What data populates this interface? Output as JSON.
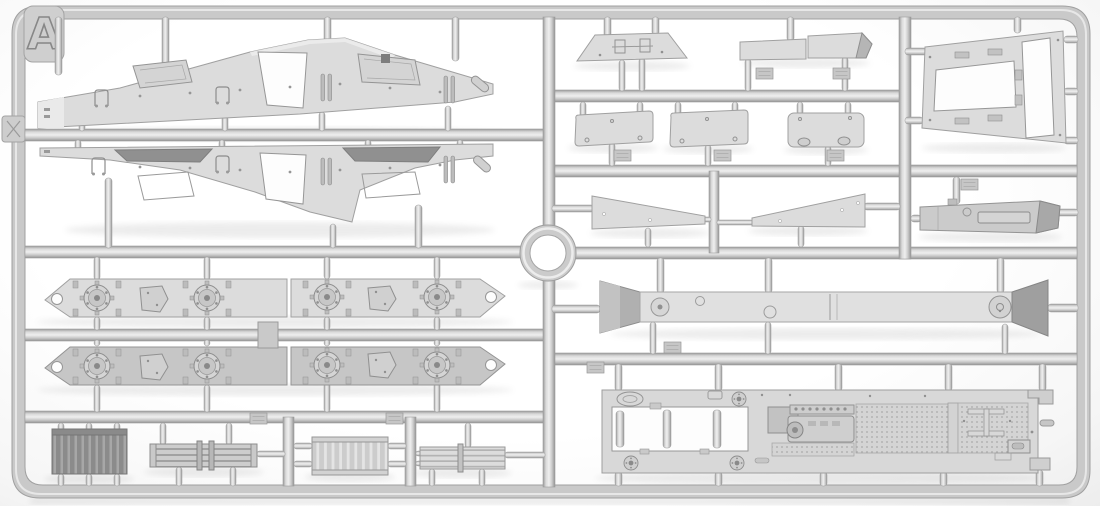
{
  "sprue": {
    "label": "A",
    "subject": "injection-molded plastic model kit sprue (parts frame) photographed on a white background",
    "plastic_color_hex": "#d3d3d3",
    "frame_color_hex": "#c9c9c9",
    "background_hex": "#ffffff",
    "sections": {
      "top_left": [
        {
          "name": "upper-hull-side-panel-a",
          "description": "long tapered hull/fender panel, center peak pointing up, trapezoidal cutout, two hatch outlines, hinge bars, bolt rows"
        },
        {
          "name": "upper-hull-side-panel-b",
          "description": "mirrored long tapered hull/fender panel, center peak pointing down, two dark recessed intakes, trapezoidal cutout, hatch outlines"
        }
      ],
      "middle_left": [
        {
          "name": "lower-hull-side-panel",
          "count": 4,
          "description": "chamfered side panels in two rows with round bolted drive hubs, small mounting plates and round lightening holes"
        }
      ],
      "bottom_left": [
        {
          "name": "radiator-core-dark",
          "description": "dark ribbed radiator block with vertical fins"
        },
        {
          "name": "muffler-with-clamps",
          "description": "horizontal slatted muffler/cooler with two clamp bands"
        },
        {
          "name": "radiator-core-light",
          "description": "light ribbed radiator block with vertical fins"
        },
        {
          "name": "slatted-cooler-light",
          "description": "light horizontal slatted cooler with center clamp"
        }
      ],
      "center": [
        {
          "name": "circular-ring",
          "description": "ring molded at the junction of the central runners"
        }
      ],
      "top_right": [
        {
          "name": "roof-plate",
          "description": "wide flat trapezoid plate with central twin bracket detail"
        },
        {
          "name": "stowage-box-pair",
          "description": "two shallow rectangular lid/box pieces, right one with angled end"
        },
        {
          "name": "mud-flap-panel",
          "count": 3,
          "description": "rounded rectangular flap panels, two slightly angled, one with two rounded feet"
        },
        {
          "name": "fender-taper-strip",
          "count": 2,
          "description": "mirrored long tapered strips with small holes"
        }
      ],
      "middle_right": [
        {
          "name": "hull-floor-beam",
          "description": "long flat beam with darker flared trapezoid ends and round hub details"
        }
      ],
      "bottom_right": [
        {
          "name": "engine-deck-plate",
          "description": "large flat deck plate with big rectangular opening, engine/transmission relief, anti-slip stippled panels, I-shaped rib detail and corner hubs"
        }
      ],
      "far_right": [
        {
          "name": "engine-compartment-frame",
          "description": "tilted trapezoid frame with one large and one narrow rectangular opening, hinge tabs on edges"
        },
        {
          "name": "fuel-tank-box",
          "description": "elongated box/tank with recessed side panel and darker angled end"
        }
      ]
    },
    "molded_tags": {
      "count": 10,
      "note": "small raised part-number tags on runners; text too small to be legible"
    },
    "runner_marks": {
      "ejector_tab_left_edge": "X",
      "corner_tab": "A"
    }
  }
}
